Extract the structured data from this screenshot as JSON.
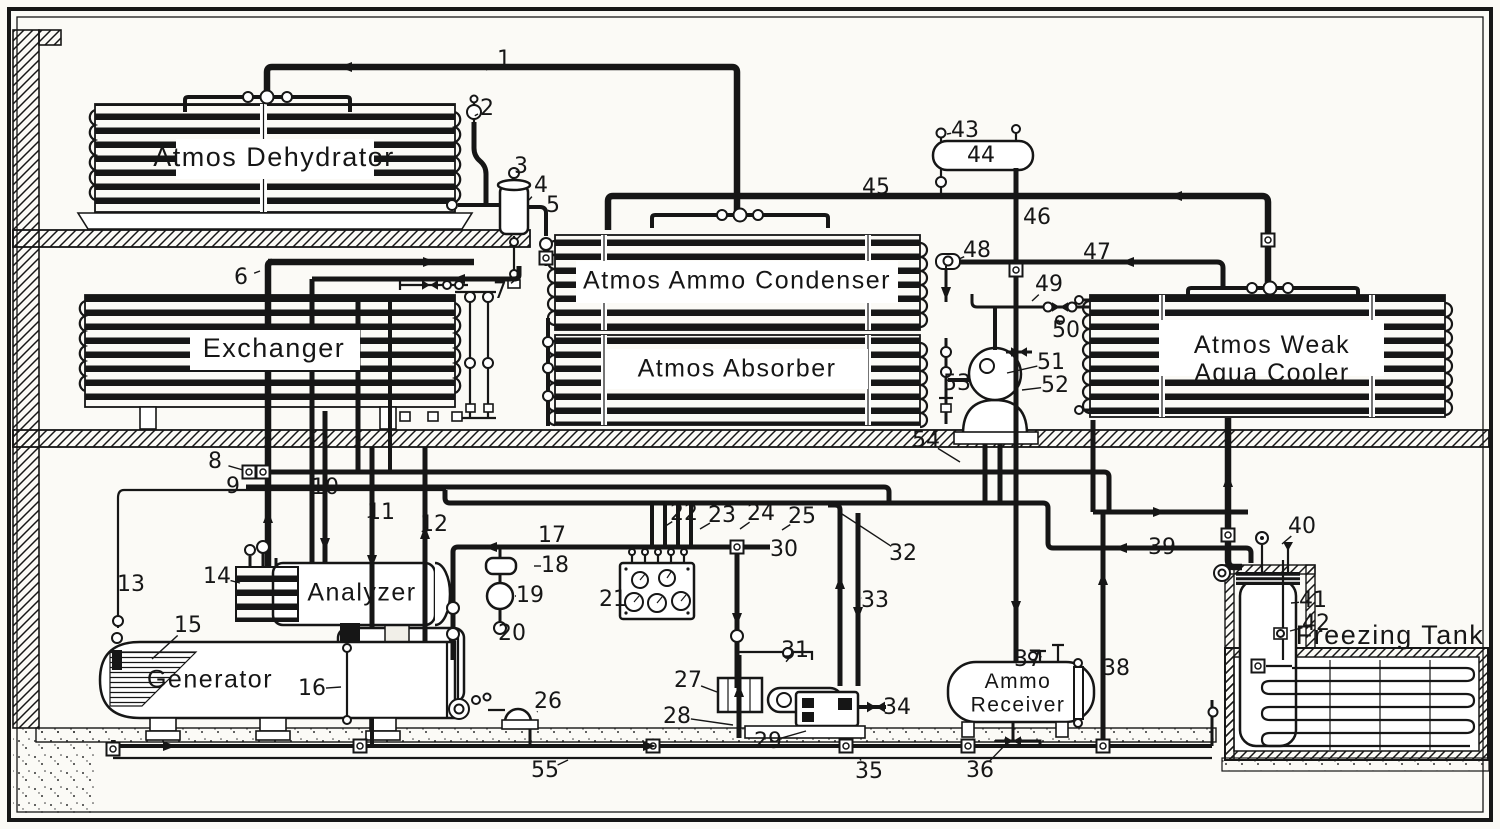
{
  "diagram": {
    "kind": "ammonia-absorption-refrigeration-schematic",
    "paper_color": "#fbfaf6",
    "ink_color": "#161616",
    "equipment": [
      {
        "id": "atmos-dehydrator",
        "label": "Atmos Dehydrator",
        "x": 274,
        "y": 159,
        "size": 27
      },
      {
        "id": "exchanger",
        "label": "Exchanger",
        "x": 274,
        "y": 350,
        "size": 27
      },
      {
        "id": "atmos-ammo-condenser",
        "label": "Atmos Ammo Condenser",
        "x": 737,
        "y": 282,
        "size": 25
      },
      {
        "id": "atmos-absorber",
        "label": "Atmos Absorber",
        "x": 737,
        "y": 370,
        "size": 25
      },
      {
        "id": "atmos-weak-aqua-cooler",
        "label": "Atmos Weak",
        "label2": "Aqua Cooler",
        "x": 1272,
        "y": 346,
        "size": 25
      },
      {
        "id": "analyzer",
        "label": "Analyzer",
        "x": 362,
        "y": 594,
        "size": 25
      },
      {
        "id": "generator",
        "label": "Generator",
        "x": 210,
        "y": 681,
        "size": 25
      },
      {
        "id": "ammo-receiver",
        "label": "Ammo",
        "label2": "Receiver",
        "x": 1018,
        "y": 682,
        "size": 21
      },
      {
        "id": "freezing-tank",
        "label": "Freezing Tank",
        "x": 1390,
        "y": 637,
        "size": 27
      }
    ],
    "callouts": [
      {
        "n": "1",
        "x": 504,
        "y": 60,
        "tx": 486,
        "ty": 70
      },
      {
        "n": "2",
        "x": 487,
        "y": 109,
        "tx": 478,
        "ty": 114
      },
      {
        "n": "3",
        "x": 521,
        "y": 167,
        "tx": 512,
        "ty": 180
      },
      {
        "n": "4",
        "x": 541,
        "y": 186,
        "tx": 529,
        "ty": 200
      },
      {
        "n": "5",
        "x": 553,
        "y": 206,
        "tx": 547,
        "ty": 218
      },
      {
        "n": "6",
        "x": 241,
        "y": 278,
        "tx": 260,
        "ty": 271
      },
      {
        "n": "7",
        "x": 500,
        "y": 292,
        "tx": 514,
        "ty": 281
      },
      {
        "n": "8",
        "x": 215,
        "y": 462,
        "tx": 243,
        "ty": 470
      },
      {
        "n": "9",
        "x": 233,
        "y": 487,
        "tx": 246,
        "ty": 488
      },
      {
        "n": "10",
        "x": 325,
        "y": 488
      },
      {
        "n": "11",
        "x": 381,
        "y": 513,
        "tx": 372,
        "ty": 516
      },
      {
        "n": "12",
        "x": 434,
        "y": 525,
        "tx": 425,
        "ty": 530
      },
      {
        "n": "13",
        "x": 131,
        "y": 585
      },
      {
        "n": "14",
        "x": 217,
        "y": 577,
        "tx": 240,
        "ty": 583
      },
      {
        "n": "15",
        "x": 188,
        "y": 626,
        "tx": 152,
        "ty": 659
      },
      {
        "n": "16",
        "x": 312,
        "y": 689,
        "tx": 341,
        "ty": 687
      },
      {
        "n": "17",
        "x": 552,
        "y": 536
      },
      {
        "n": "18",
        "x": 555,
        "y": 566,
        "tx": 534,
        "ty": 566
      },
      {
        "n": "19",
        "x": 530,
        "y": 596,
        "tx": 515,
        "ty": 596
      },
      {
        "n": "20",
        "x": 512,
        "y": 634,
        "tx": 505,
        "ty": 626
      },
      {
        "n": "21",
        "x": 613,
        "y": 600,
        "tx": 626,
        "ty": 598
      },
      {
        "n": "22",
        "x": 684,
        "y": 514,
        "tx": 664,
        "ty": 527
      },
      {
        "n": "23",
        "x": 722,
        "y": 516,
        "tx": 700,
        "ty": 529
      },
      {
        "n": "24",
        "x": 761,
        "y": 514,
        "tx": 740,
        "ty": 529
      },
      {
        "n": "25",
        "x": 802,
        "y": 517,
        "tx": 782,
        "ty": 530
      },
      {
        "n": "26",
        "x": 548,
        "y": 702,
        "tx": 537,
        "ty": 712
      },
      {
        "n": "27",
        "x": 688,
        "y": 681,
        "tx": 717,
        "ty": 692
      },
      {
        "n": "28",
        "x": 677,
        "y": 717,
        "tx": 733,
        "ty": 725
      },
      {
        "n": "29",
        "x": 768,
        "y": 742,
        "tx": 806,
        "ty": 731
      },
      {
        "n": "30",
        "x": 784,
        "y": 550
      },
      {
        "n": "31",
        "x": 795,
        "y": 651,
        "tx": 790,
        "ty": 657
      },
      {
        "n": "32",
        "x": 903,
        "y": 554,
        "tx": 839,
        "ty": 512
      },
      {
        "n": "33",
        "x": 875,
        "y": 601,
        "tx": 861,
        "ty": 598
      },
      {
        "n": "34",
        "x": 897,
        "y": 708
      },
      {
        "n": "35",
        "x": 869,
        "y": 772,
        "tx": 860,
        "ty": 759
      },
      {
        "n": "36",
        "x": 980,
        "y": 771,
        "tx": 1008,
        "ty": 742
      },
      {
        "n": "37",
        "x": 1028,
        "y": 660,
        "tx": 1040,
        "ty": 657
      },
      {
        "n": "38",
        "x": 1116,
        "y": 669
      },
      {
        "n": "39",
        "x": 1162,
        "y": 548
      },
      {
        "n": "40",
        "x": 1302,
        "y": 527,
        "tx": 1282,
        "ty": 544
      },
      {
        "n": "41",
        "x": 1313,
        "y": 601,
        "tx": 1291,
        "ty": 603
      },
      {
        "n": "42",
        "x": 1316,
        "y": 624,
        "tx": 1290,
        "ty": 631
      },
      {
        "n": "43",
        "x": 965,
        "y": 131,
        "tx": 947,
        "ty": 134
      },
      {
        "n": "44",
        "x": 981,
        "y": 156
      },
      {
        "n": "45",
        "x": 876,
        "y": 188
      },
      {
        "n": "46",
        "x": 1037,
        "y": 218
      },
      {
        "n": "47",
        "x": 1097,
        "y": 253
      },
      {
        "n": "48",
        "x": 977,
        "y": 251,
        "tx": 959,
        "ty": 259
      },
      {
        "n": "49",
        "x": 1049,
        "y": 285,
        "tx": 1032,
        "ty": 301
      },
      {
        "n": "50",
        "x": 1066,
        "y": 331,
        "tx": 1060,
        "ty": 323
      },
      {
        "n": "51",
        "x": 1051,
        "y": 363,
        "tx": 1007,
        "ty": 373
      },
      {
        "n": "52",
        "x": 1055,
        "y": 386,
        "tx": 1022,
        "ty": 390
      },
      {
        "n": "53",
        "x": 957,
        "y": 384
      },
      {
        "n": "54",
        "x": 926,
        "y": 441,
        "tx": 960,
        "ty": 462
      },
      {
        "n": "55",
        "x": 545,
        "y": 771,
        "tx": 568,
        "ty": 760
      }
    ]
  }
}
